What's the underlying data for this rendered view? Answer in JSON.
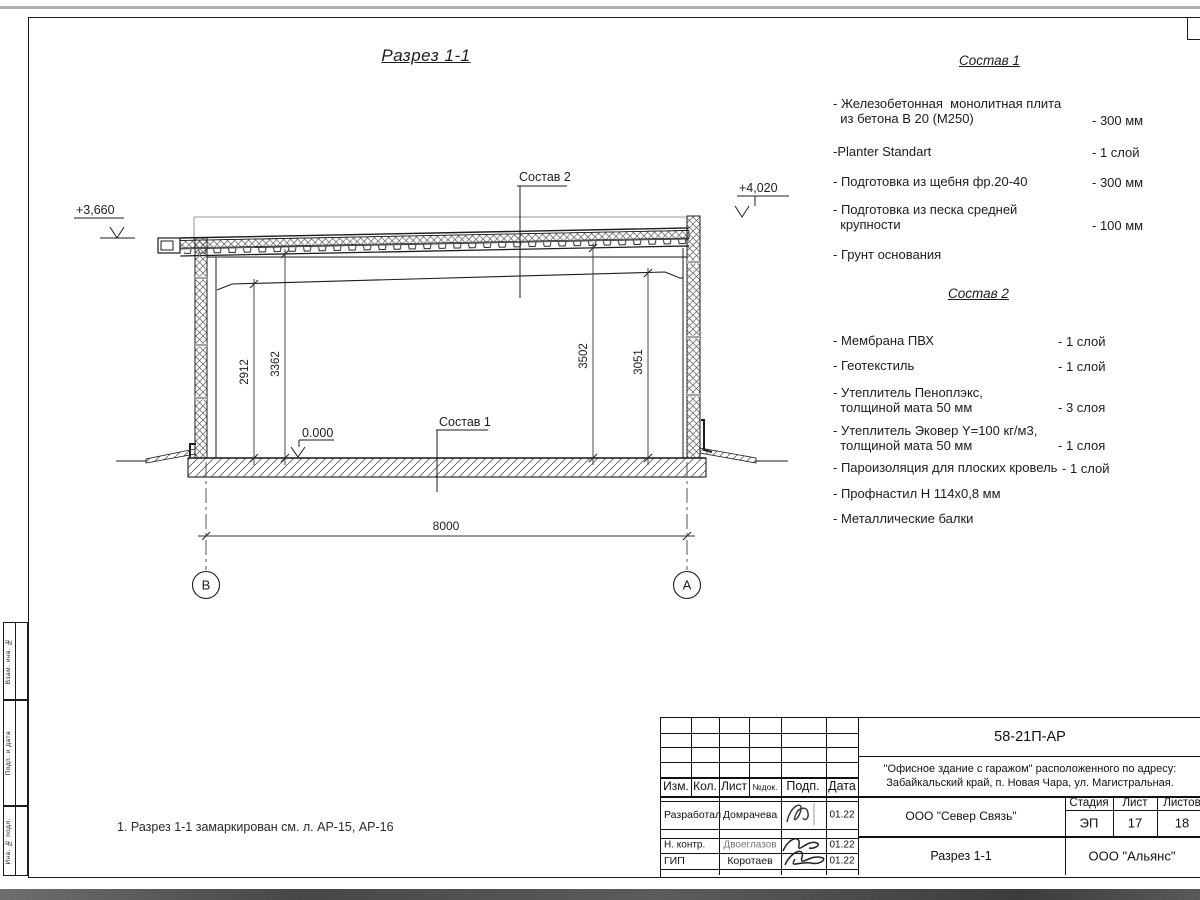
{
  "page": {
    "note": "1. Разрез 1-1 замаркирован см. л. АР-15, АР-16"
  },
  "drawing": {
    "title": "Разрез 1-1",
    "labels": {
      "sostav1": "Состав 1",
      "sostav2": "Состав 2"
    },
    "elevations": {
      "left": "+3,660",
      "right": "+4,020",
      "zero": "0.000"
    },
    "dimensions": {
      "left_inner": "2912",
      "left_outer": "3362",
      "right_outer": "3502",
      "right_inner": "3051",
      "span": "8000"
    },
    "axes": {
      "left": "В",
      "right": "А"
    }
  },
  "composition1": {
    "title": "Состав 1",
    "items": [
      {
        "name": "- Железобетонная  монолитная плита\n  из бетона В 20 (М250)",
        "value": "- 300 мм"
      },
      {
        "name": "-Planter Standart",
        "value": "- 1 слой"
      },
      {
        "name": "- Подготовка из щебня фр.20-40",
        "value": "- 300 мм"
      },
      {
        "name": "- Подготовка из песка средней\n  крупности",
        "value": "- 100 мм"
      },
      {
        "name": "- Грунт основания",
        "value": ""
      }
    ]
  },
  "composition2": {
    "title": "Состав 2",
    "items": [
      {
        "name": "- Мембрана ПВХ",
        "value": "- 1 слой"
      },
      {
        "name": "- Геотекстиль",
        "value": "- 1 слой"
      },
      {
        "name": "- Утеплитель Пеноплэкс,\n  толщиной мата 50 мм",
        "value": "- 3  слоя"
      },
      {
        "name": "- Утеплитель Эковер Y=100 кг/м3,\n  толщиной мата 50 мм",
        "value": "- 1 слоя"
      },
      {
        "name": "- Пароизоляция для плоских кровель",
        "value": "- 1 слой"
      },
      {
        "name": "- Профнастил Н 114х0,8 мм",
        "value": ""
      },
      {
        "name": "- Металлические балки",
        "value": ""
      }
    ]
  },
  "title_block": {
    "doc_number": "58-21П-АР",
    "project_line1": "\"Офисное здание с гаражом\" расположенного по адресу:",
    "project_line2": "Забайкальский край, п. Новая Чара, ул. Магистральная.",
    "columns": [
      "Изм.",
      "Кол.",
      "Лист",
      "№док.",
      "Подп.",
      "Дата"
    ],
    "rows": [
      {
        "role": "Разработал",
        "name": "Домрачева",
        "date": "01.22"
      },
      {
        "role": "Н. контр.",
        "name": "Двоеглазов",
        "date": "01.22"
      },
      {
        "role": "ГИП",
        "name": "Коротаев",
        "date": "01.22"
      }
    ],
    "contractor": "ООО \"Север Связь\"",
    "designer": "ООО \"Альянс\"",
    "sheet_title": "Разрез 1-1",
    "stage_label": "Стадия",
    "sheet_label": "Лист",
    "sheets_label": "Листов",
    "stage": "ЭП",
    "sheet": "17",
    "sheets": "18"
  },
  "side_stamp": {
    "labels": [
      "Взам. инв. №",
      "Подп. и дата",
      "Инв. № подл."
    ]
  }
}
